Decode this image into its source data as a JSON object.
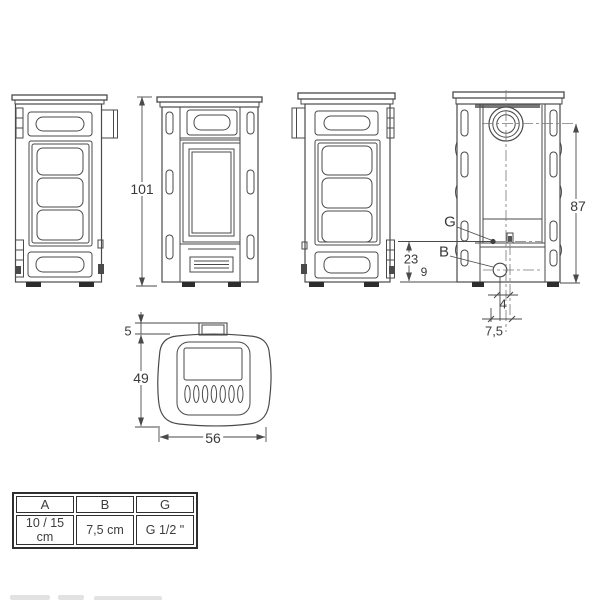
{
  "page": {
    "background": "#ffffff",
    "line_color": "#4a4a4a",
    "text_color": "#3a3a3a"
  },
  "drawing": {
    "views": {
      "side_left": "stove-side-view-left",
      "front": "stove-front-view",
      "side_right": "stove-side-view-right",
      "rear": "stove-rear-view",
      "top": "stove-top-view"
    },
    "dimensions": {
      "overall_height": "101",
      "flue_center_height": "87",
      "g_connection_height": "23",
      "rear_edge_offset": "9",
      "b_offset": "4",
      "b_spacing": "7,5",
      "flue_stub_depth": "5",
      "body_depth": "49",
      "body_width": "56"
    },
    "labels": {
      "g": "G",
      "b": "B"
    }
  },
  "spec_table": {
    "headers": [
      "A",
      "B",
      "G"
    ],
    "values": [
      "10 / 15 cm",
      "7,5 cm",
      "G 1/2 \""
    ]
  }
}
